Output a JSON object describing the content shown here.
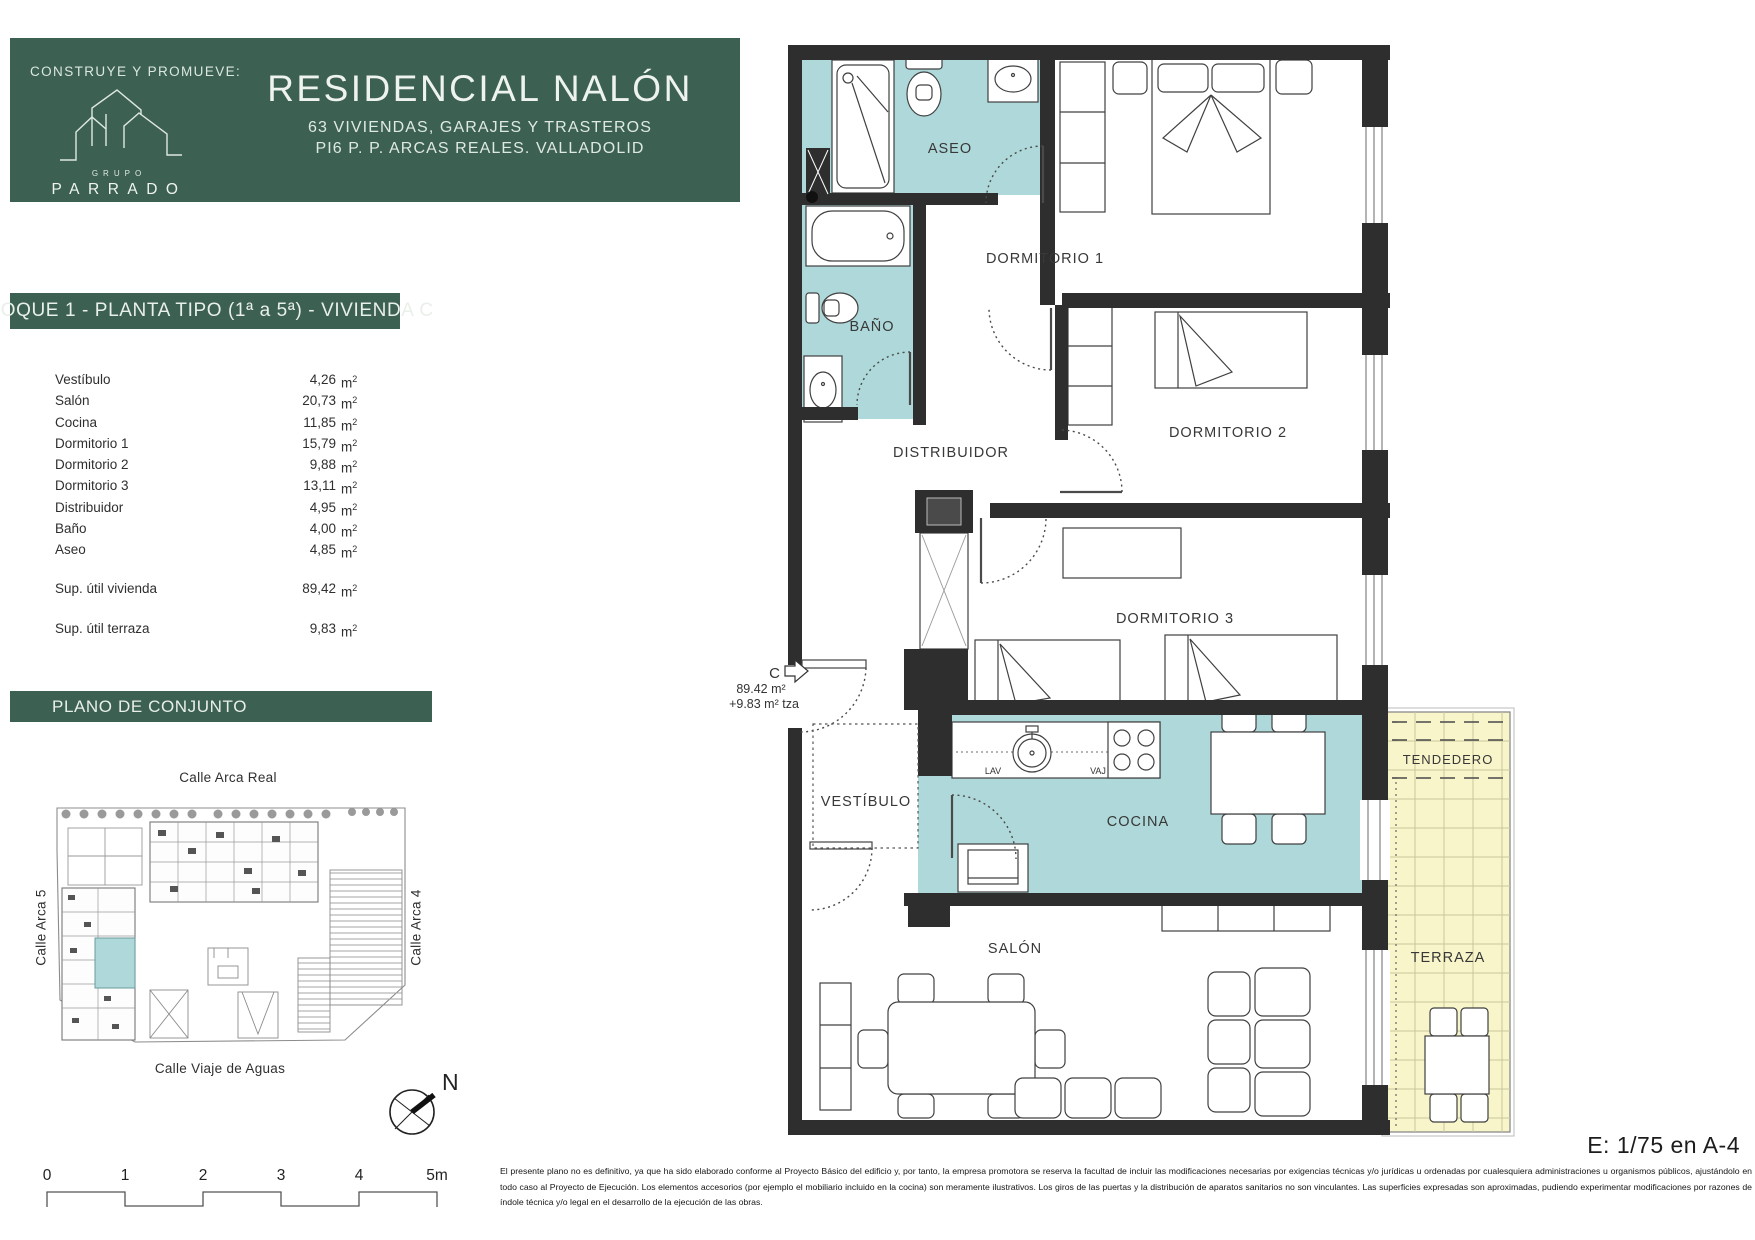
{
  "header": {
    "promote_label": "CONSTRUYE Y PROMUEVE:",
    "logo_top": "GRUPO",
    "logo_name": "PARRADO",
    "title": "RESIDENCIAL NALÓN",
    "subtitle_1": "63 VIVIENDAS, GARAJES Y TRASTEROS",
    "subtitle_2": "PI6 P. P. ARCAS REALES. VALLADOLID"
  },
  "unit_banner": "BLOQUE 1 - PLANTA TIPO (1ª a 5ª)  - VIVIENDA C",
  "surface_table": {
    "unit": "m",
    "unit_exp": "2",
    "rows": [
      {
        "label": "Vestíbulo",
        "value": "4,26"
      },
      {
        "label": "Salón",
        "value": "20,73"
      },
      {
        "label": "Cocina",
        "value": "11,85"
      },
      {
        "label": "Dormitorio 1",
        "value": "15,79"
      },
      {
        "label": "Dormitorio 2",
        "value": "9,88"
      },
      {
        "label": "Dormitorio 3",
        "value": "13,11"
      },
      {
        "label": "Distribuidor",
        "value": "4,95"
      },
      {
        "label": "Baño",
        "value": "4,00"
      },
      {
        "label": "Aseo",
        "value": "4,85"
      }
    ],
    "totals": [
      {
        "label": "Sup. útil vivienda",
        "value": "89,42"
      },
      {
        "label": "Sup. útil terraza",
        "value": "9,83"
      }
    ]
  },
  "site_plan": {
    "banner": "PLANO DE CONJUNTO",
    "street_top": "Calle Arca Real",
    "street_left": "Calle Arca 5",
    "street_right": "Calle Arca 4",
    "street_bottom": "Calle Viaje de Aguas",
    "north": "N"
  },
  "scale_bar": {
    "t0": "0",
    "t1": "1",
    "t2": "2",
    "t3": "3",
    "t4": "4",
    "t5": "5m"
  },
  "floor_plan": {
    "rooms": {
      "aseo": "ASEO",
      "bano": "BAÑO",
      "dorm1": "DORMITORIO 1",
      "dorm2": "DORMITORIO 2",
      "dorm3": "DORMITORIO 3",
      "distribuidor": "DISTRIBUIDOR",
      "vestibulo": "VESTÍBULO",
      "cocina": "COCINA",
      "salon": "SALÓN",
      "tendedero": "TENDEDERO",
      "terraza": "TERRAZA"
    },
    "kitchen": {
      "lav": "LAV",
      "vaj": "VAJ"
    },
    "unit_tag": {
      "letter": "C",
      "area": "89.42 m²",
      "terrace": "+9.83 m² tza"
    }
  },
  "notes": {
    "scale_note": "E: 1/75 en A-4",
    "disclaimer": [
      "El presente plano no es definitivo, ya que ha sido elaborado conforme al Proyecto Básico del edificio y, por tanto, la empresa promotora se reserva la facultad de incluir las modificaciones necesarias por exigencias técnicas y/o jurídicas u ordenadas por cualesquiera administraciones u organismos públicos, ajustándolo en",
      "todo caso al Proyecto de Ejecución. Los elementos accesorios (por ejemplo el mobiliario incluido en la cocina) son meramente ilustrativos. Los giros de las puertas y la distribución de aparatos sanitarios no son vinculantes. Las superficies expresadas son aproximadas, pudiendo experimentar modificaciones por razones de",
      "índole técnica y/o legal en el desarrollo de la ejecución de las obras."
    ]
  },
  "colors": {
    "brand_green": "#3c6153",
    "room_teal": "#aed8d9",
    "terrace_yellow": "#f7f5c9",
    "wall": "#2e2e2e"
  }
}
